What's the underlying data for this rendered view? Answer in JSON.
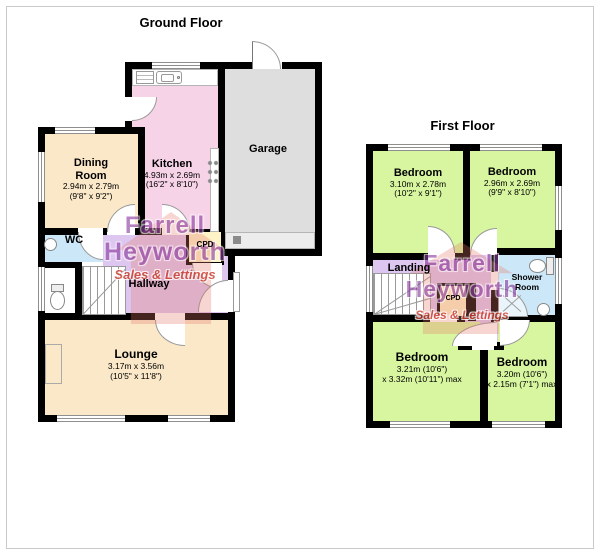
{
  "meta": {
    "kind": "estate-agent floorplan"
  },
  "colors": {
    "wall": "#000000",
    "bedroom_green": "#d8f6a0",
    "kitchen_pink": "#f7d3e8",
    "lounge_cream": "#fae8c9",
    "hall_lavender": "#ddc6f0",
    "bath_blue": "#cce7f7",
    "cupboard_yellow": "#fdf3c6",
    "garage_grey": "#dedede",
    "watermark_purple": "#8a3aa0",
    "watermark_red": "#c93a2c"
  },
  "watermark": {
    "line1": "Farrell",
    "line2": "Heyworth",
    "line3": "Sales & Lettings"
  },
  "ground_floor": {
    "title": "Ground Floor",
    "rooms": {
      "dining": {
        "name": "Dining Room",
        "dims_m": "2.94m x 2.79m",
        "dims_ft": "(9'8\" x 9'2\")"
      },
      "kitchen": {
        "name": "Kitchen",
        "dims_m": "4.93m x 2.69m",
        "dims_ft": "(16'2\" x 8'10\")"
      },
      "garage": {
        "name": "Garage"
      },
      "wc": {
        "name": "WC"
      },
      "hallway": {
        "name": "Hallway"
      },
      "cupboard": {
        "name": "CPD"
      },
      "lounge": {
        "name": "Lounge",
        "dims_m": "3.17m x 3.56m",
        "dims_ft": "(10'5\" x 11'8\")"
      }
    },
    "fixtures": [
      "kitchen-sink",
      "draining-board",
      "hob",
      "wc-basin",
      "toilet",
      "stairs",
      "garage-door",
      "fireplace"
    ]
  },
  "first_floor": {
    "title": "First Floor",
    "rooms": {
      "bedroom_top_left": {
        "name": "Bedroom",
        "dims_m": "3.10m x 2.78m",
        "dims_ft": "(10'2\" x 9'1\")"
      },
      "bedroom_top_right": {
        "name": "Bedroom",
        "dims_m": "2.96m x 2.69m",
        "dims_ft": "(9'9\" x 8'10\")"
      },
      "landing": {
        "name": "Landing"
      },
      "cupboard": {
        "name": "CPD"
      },
      "shower_room": {
        "name": "Shower Room"
      },
      "bedroom_bottom_left": {
        "name": "Bedroom",
        "dims_line1": "3.21m (10'6\")",
        "dims_line2": "x 3.32m (10'11\") max"
      },
      "bedroom_bottom_right": {
        "name": "Bedroom",
        "dims_line1": "3.20m (10'6\")",
        "dims_line2": "x 2.15m (7'1\") max"
      }
    },
    "fixtures": [
      "stairs",
      "shower-tray",
      "toilet",
      "basin"
    ]
  }
}
